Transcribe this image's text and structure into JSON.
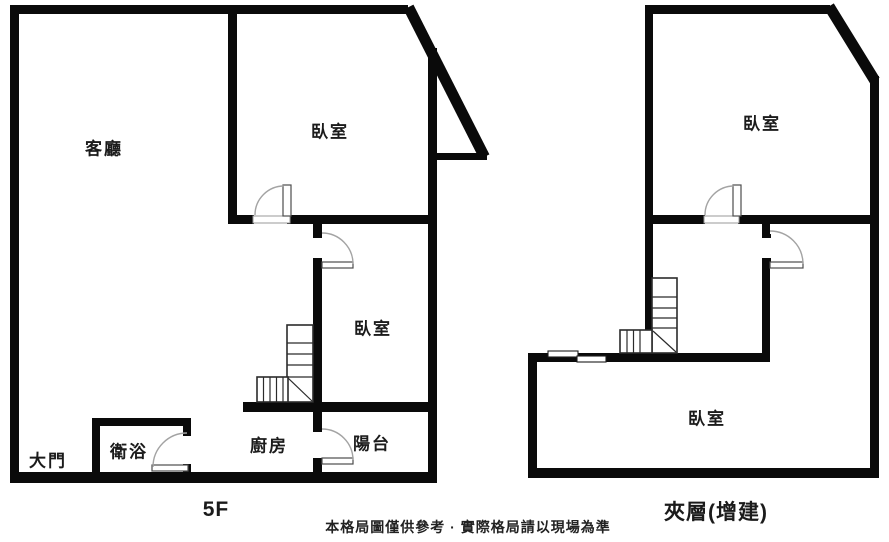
{
  "colors": {
    "wall": "#0a0a0a",
    "background": "#ffffff",
    "door_arc": "#a3a3a3",
    "door_leaf_border": "#4d4d4d",
    "stair_line": "#2b2b2b",
    "text": "#1b1b1b"
  },
  "plans": [
    {
      "name": "floor-5",
      "floor_label": "5F",
      "rooms": [
        {
          "key": "living-room",
          "label": "客廳"
        },
        {
          "key": "bedroom-upper",
          "label": "臥室"
        },
        {
          "key": "bedroom-lower",
          "label": "臥室"
        },
        {
          "key": "main-entrance",
          "label": "大門"
        },
        {
          "key": "bathroom",
          "label": "衛浴"
        },
        {
          "key": "kitchen",
          "label": "廚房"
        },
        {
          "key": "balcony",
          "label": "陽台"
        }
      ]
    },
    {
      "name": "mezzanine",
      "floor_label": "夾層(增建)",
      "rooms": [
        {
          "key": "bedroom-upper",
          "label": "臥室"
        },
        {
          "key": "bedroom-lower",
          "label": "臥室"
        }
      ]
    }
  ],
  "disclaimer": "本格局圖僅供參考 · 實際格局請以現場為準"
}
